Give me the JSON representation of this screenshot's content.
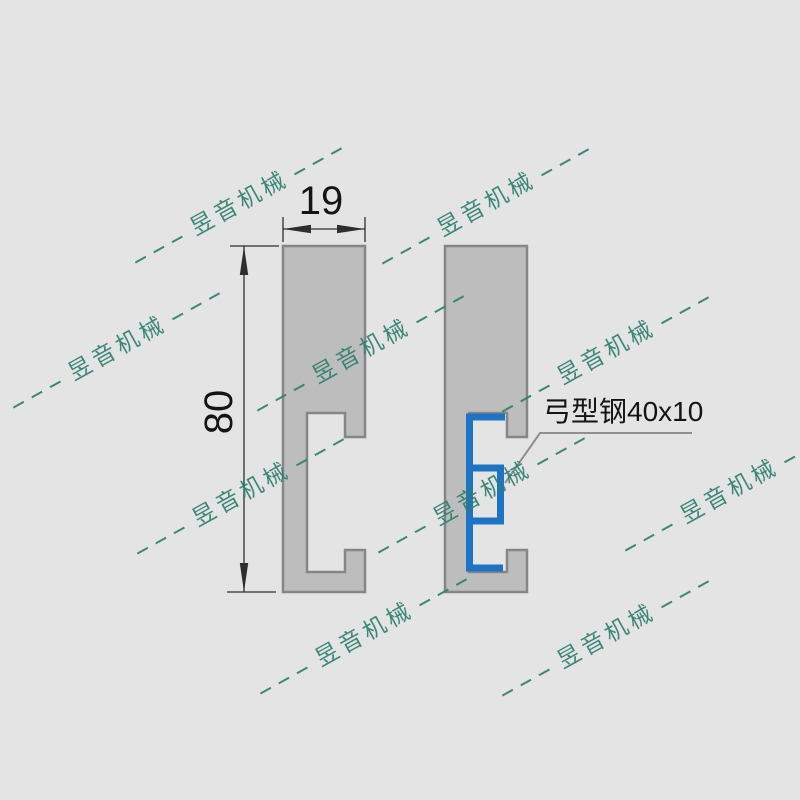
{
  "drawing": {
    "dimensions": {
      "width": "19",
      "height": "80"
    },
    "callout": {
      "label": "弓型钢40x10"
    },
    "watermark": {
      "text": "昱音机械",
      "positions": [
        {
          "x": 240,
          "y": 204
        },
        {
          "x": 487,
          "y": 205
        },
        {
          "x": 118,
          "y": 349
        },
        {
          "x": 362,
          "y": 352
        },
        {
          "x": 607,
          "y": 353
        },
        {
          "x": 242,
          "y": 495
        },
        {
          "x": 483,
          "y": 494
        },
        {
          "x": 730,
          "y": 492
        },
        {
          "x": 365,
          "y": 635
        },
        {
          "x": 607,
          "y": 637
        }
      ]
    },
    "colors": {
      "background": "#e4e4e4",
      "profile_fill": "#bdbdbd",
      "profile_border": "#868686",
      "bow_steel_blue": "#1e73c5",
      "dimension_line": "#2e2e2e",
      "leader_line": "#8f8f8f",
      "text": "#141414",
      "watermark": "#2e8070"
    }
  }
}
